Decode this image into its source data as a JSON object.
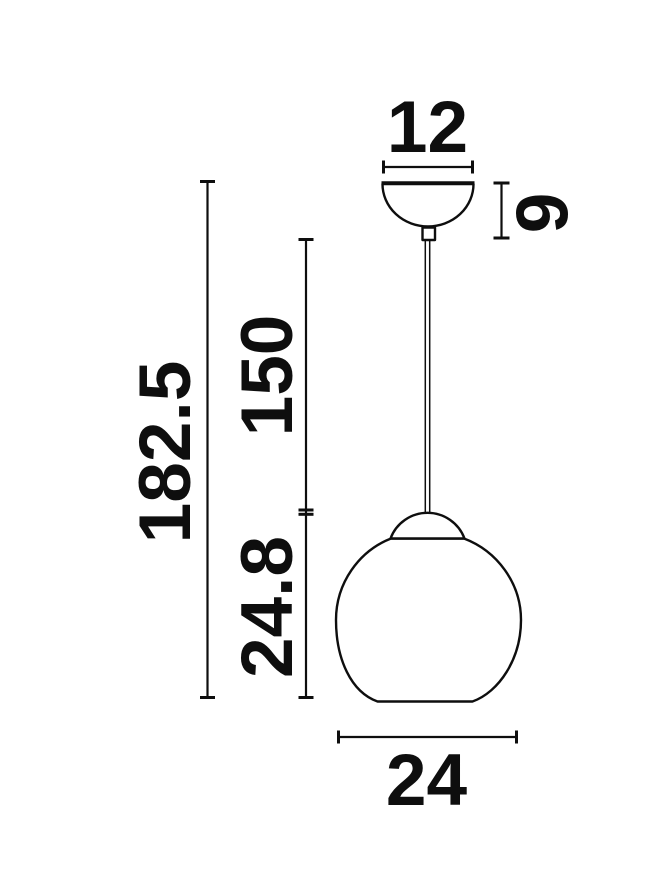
{
  "diagram": {
    "background_color": "#ffffff",
    "line_color": "#0e0e0e",
    "dimensions": {
      "canopy_width": "12",
      "canopy_height": "9",
      "overall_height": "182.5",
      "cord_length": "150",
      "shade_height": "24.8",
      "shade_diameter": "24"
    }
  }
}
